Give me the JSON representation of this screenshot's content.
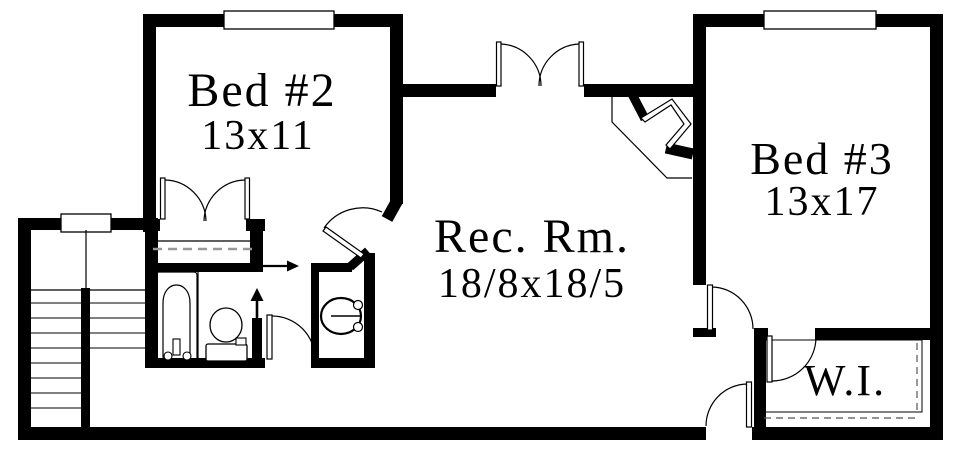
{
  "rooms": {
    "bed2": {
      "label": "Bed #2",
      "dims": "13x11"
    },
    "rec": {
      "label": "Rec. Rm.",
      "dims": "18/8x18/5"
    },
    "bed3": {
      "label": "Bed #3",
      "dims": "13x17"
    },
    "wi": {
      "label": "W.I."
    }
  },
  "fixtures": [
    "bathtub",
    "toilet",
    "vanity-sink",
    "stairs"
  ],
  "symbols": {
    "up_arrow": "direction-up-arrow",
    "right_arrow": "direction-right-arrow"
  },
  "windows_count": 3,
  "colors": {
    "wall": "#000000",
    "background": "#ffffff",
    "closet_dash": "#999999",
    "wi_dash": "#555555"
  }
}
